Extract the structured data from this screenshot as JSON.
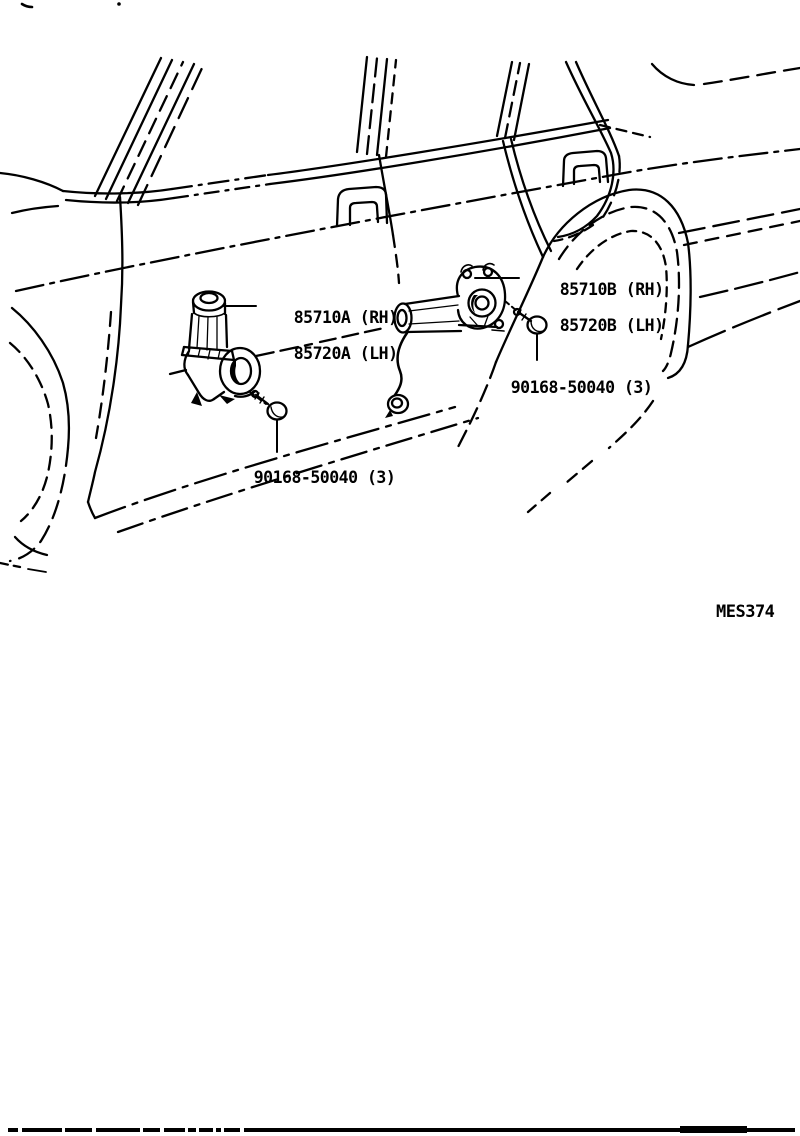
{
  "diagram": {
    "description": "Toyota parts catalog line illustration: vehicle left side view with front and rear power window motors",
    "figure_code": "MES374",
    "labels": {
      "front_motor": {
        "line1": "85710A (RH)",
        "line2": "85720A (LH)"
      },
      "rear_motor": {
        "line1": "85710B (RH)",
        "line2": "85720B (LH)"
      },
      "front_screw": "90168-50040 (3)",
      "rear_screw": "90168-50040 (3)"
    },
    "colors": {
      "ink": "#000000",
      "paper": "#ffffff"
    }
  }
}
